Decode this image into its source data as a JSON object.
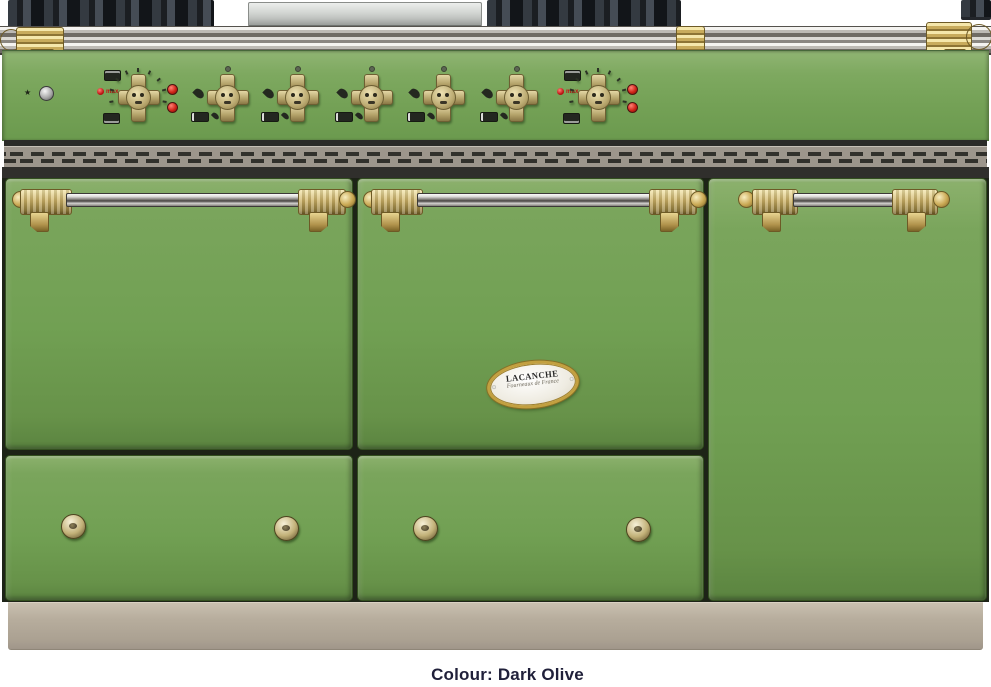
{
  "caption": "Colour: Dark Olive",
  "badge": {
    "brand": "LACANCHE",
    "tagline": "Fourneaux de France"
  },
  "control_panel": {
    "max_label": "max",
    "knobs": [
      {
        "type": "oven",
        "name": "left-oven-thermostat-knob"
      },
      {
        "type": "burner",
        "name": "burner-control-knob-1"
      },
      {
        "type": "burner",
        "name": "burner-control-knob-2"
      },
      {
        "type": "burner",
        "name": "burner-control-knob-3"
      },
      {
        "type": "burner",
        "name": "burner-control-knob-4"
      },
      {
        "type": "burner",
        "name": "burner-control-knob-5"
      },
      {
        "type": "oven",
        "name": "right-oven-thermostat-knob"
      }
    ],
    "icons": {
      "star": "star-icon",
      "igniter": "igniter-button",
      "flame": "flame-icon",
      "burner_zone": "burner-zone-icon",
      "grill": "grill-mode-icon",
      "oven": "oven-mode-icon",
      "indicator": "red-indicator-light"
    }
  },
  "colors": {
    "enamel_green": "#74a156",
    "brass_trim": "#c8ab5c",
    "steel_rail": "#bdbab5",
    "plinth_beige": "#b7ad9d",
    "vent_gray": "#9d968c",
    "caption_text": "#20203a",
    "indicator_red": "#d02418"
  }
}
